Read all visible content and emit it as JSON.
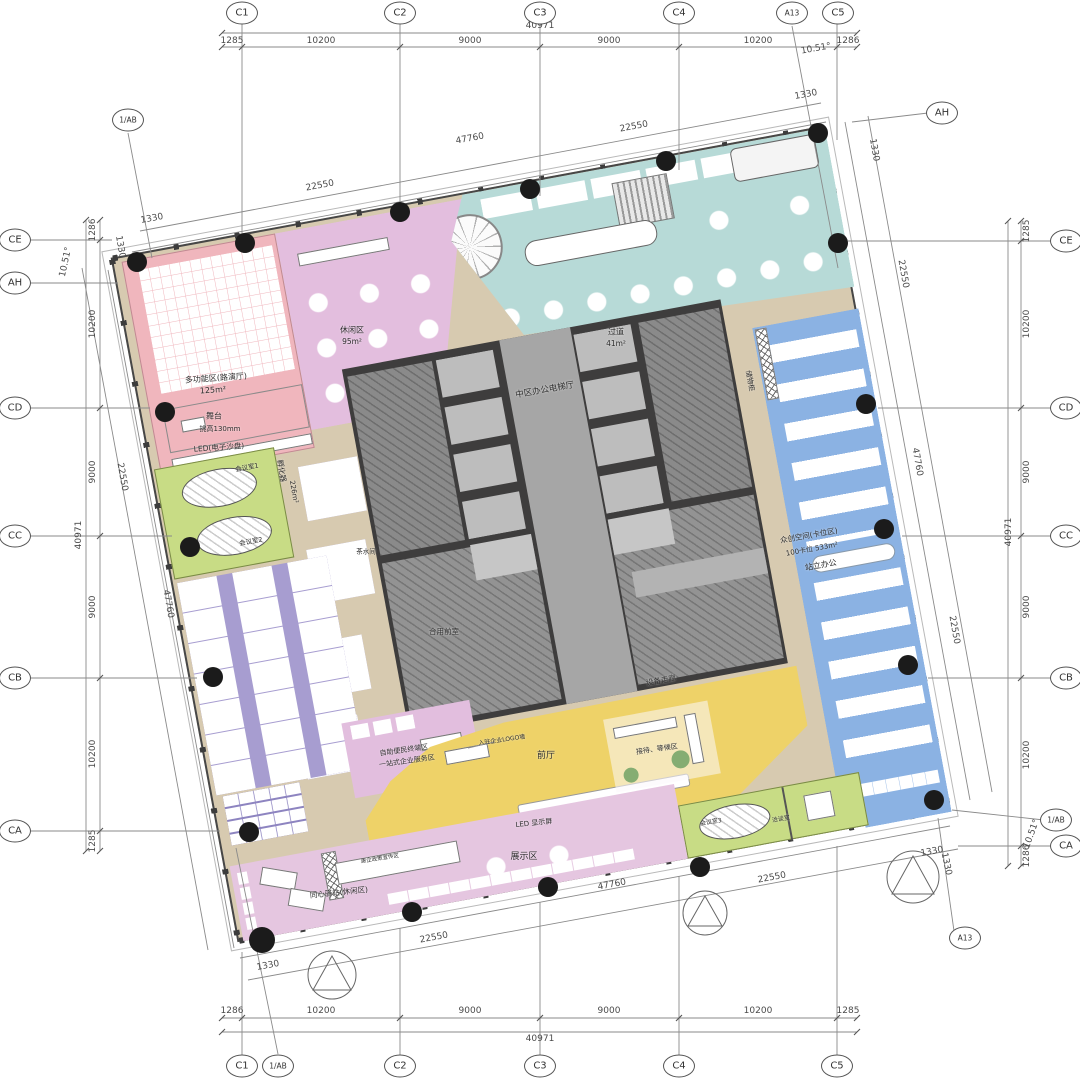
{
  "grid": {
    "top": [
      "C1",
      "C2",
      "C3",
      "C4",
      "A13",
      "C5"
    ],
    "bottom": [
      "C1",
      "1/AB",
      "C2",
      "C3",
      "C4",
      "C5"
    ],
    "left": [
      "CE",
      "AH",
      "CD",
      "CC",
      "CB",
      "CA"
    ],
    "right": [
      "CE",
      "CD",
      "CC",
      "CB",
      "1/AB",
      "CA"
    ],
    "corner_top_left": "1/AB",
    "corner_top_right": "AH",
    "corner_bottom_right": "A13"
  },
  "dims": {
    "total": "40971",
    "seg_1285": "1285",
    "seg_1286": "1286",
    "seg_10200": "10200",
    "seg_9000": "9000",
    "angle": "10.51°",
    "diag_total": "47760",
    "diag_half": "22550",
    "diag_offset": "1330"
  },
  "zones": {
    "multifunction": {
      "name": "多功能区(路演厅)",
      "area": "125m²"
    },
    "stage": {
      "name": "舞台",
      "note": "挑高130mm"
    },
    "led_wall": "LED(电子沙盘)",
    "lounge": {
      "name": "休闲区",
      "area": "95m²"
    },
    "corridor": {
      "name": "过道",
      "area": "41m²"
    },
    "elevator_hall": "中区办公电梯厅",
    "tea_room": "茶水间",
    "shared_front_room": "合用前室",
    "equipment_corridor": "设备走廊",
    "lockers": "储物柜",
    "incubator": {
      "name": "孵化器",
      "area": "226m²"
    },
    "meeting_1": "会议室1",
    "meeting_2": "会议室2",
    "coworking": {
      "name": "众创空间(卡位区)",
      "capacity": "100卡位 533m²",
      "button": "站立办公"
    },
    "self_service": "自助便民终端区",
    "one_stop": "一站式企业服务区",
    "logo_wall": "入驻企业LOGO墙",
    "front_hall": "前厅",
    "led_screen": "LED 显示屏",
    "exhibition": "展示区",
    "reception": "接待、等候区",
    "station": "同心驿站(休闲区)",
    "policy_wall": "惠企政策宣传区",
    "meeting_3": "会议室3",
    "talk_room": "洽谈室"
  },
  "colors": {
    "multifunction_pink": "#f0b6bd",
    "lounge_lavender": "#e3bede",
    "dining_teal": "#b7dad7",
    "coworking_blue": "#8bb2e3",
    "workstation_purple": "#8d84c0",
    "workstation_purple_light": "#a79dd0",
    "meeting_green": "#c8dc85",
    "front_hall_yellow": "#eed268",
    "corridor_tan": "#d7cab0",
    "core_dark": "#3e3d3d",
    "exhibition_pink": "#e5c6e0",
    "annotation_gray": "#777777",
    "dot_black": "#1b1b1b"
  }
}
